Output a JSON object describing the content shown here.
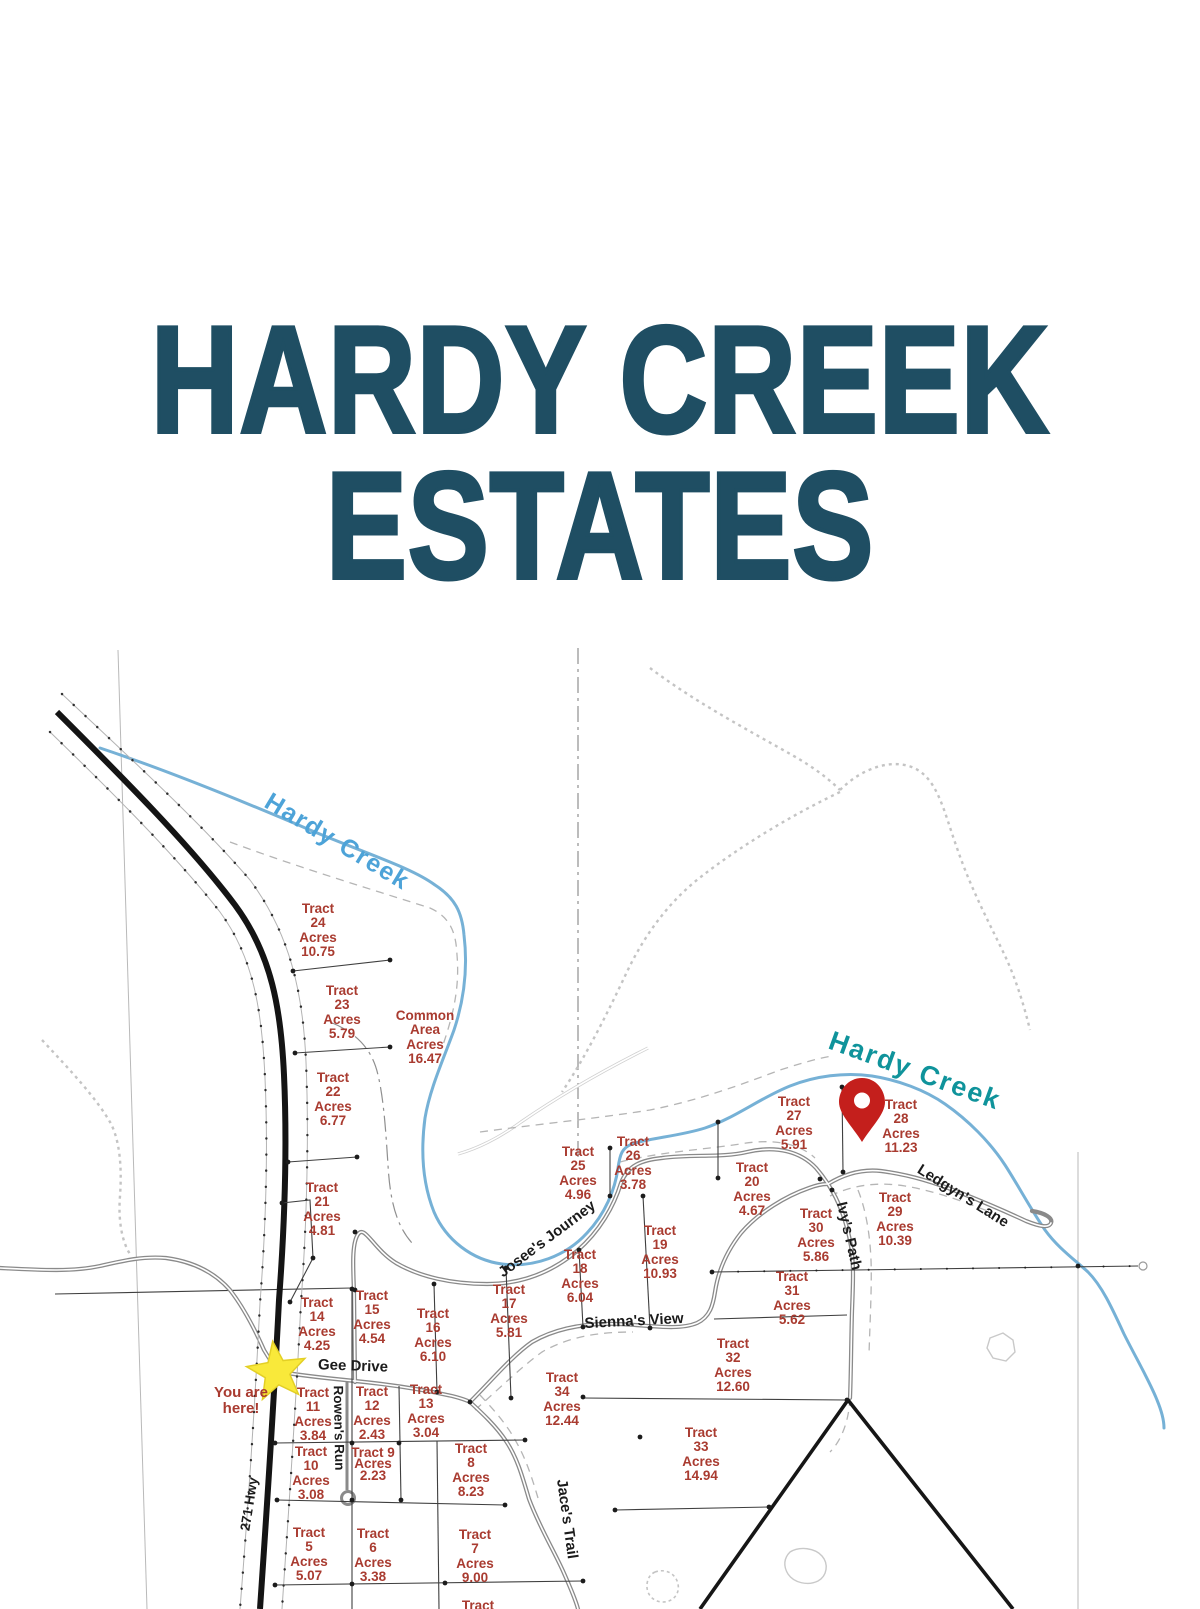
{
  "title": {
    "line1": "HARDY CREEK",
    "line2": "ESTATES"
  },
  "colors": {
    "title": "#1f4e63",
    "tract_text": "#a93b30",
    "creek": "#76b1d6",
    "creek_label_left": "#4da3d8",
    "creek_label_right": "#0f939b",
    "road": "#8a8a8a",
    "highway": "#141414",
    "star": "#f9e93a",
    "pin": "#c41f1c"
  },
  "map": {
    "tracts": [
      {
        "id": "tract-24",
        "lines": [
          "Tract",
          "24",
          "Acres",
          "10.75"
        ],
        "x": 318,
        "y": 931
      },
      {
        "id": "tract-23",
        "lines": [
          "Tract",
          "23",
          "Acres",
          "5.79"
        ],
        "x": 342,
        "y": 1013
      },
      {
        "id": "common-area",
        "lines": [
          "Common",
          "Area",
          "Acres",
          "16.47"
        ],
        "x": 425,
        "y": 1038
      },
      {
        "id": "tract-22",
        "lines": [
          "Tract",
          "22",
          "Acres",
          "6.77"
        ],
        "x": 333,
        "y": 1100
      },
      {
        "id": "tract-21",
        "lines": [
          "Tract",
          "21",
          "Acres",
          "4.81"
        ],
        "x": 322,
        "y": 1210
      },
      {
        "id": "tract-25",
        "lines": [
          "Tract",
          "25",
          "Acres",
          "4.96"
        ],
        "x": 578,
        "y": 1174
      },
      {
        "id": "tract-26",
        "lines": [
          "Tract",
          "26",
          "Acres",
          "3.78"
        ],
        "x": 633,
        "y": 1164
      },
      {
        "id": "tract-27",
        "lines": [
          "Tract",
          "27",
          "Acres",
          "5.91"
        ],
        "x": 794,
        "y": 1124
      },
      {
        "id": "tract-28",
        "lines": [
          "Tract",
          "28",
          "Acres",
          "11.23"
        ],
        "x": 901,
        "y": 1127
      },
      {
        "id": "tract-20",
        "lines": [
          "Tract",
          "20",
          "Acres",
          "4.67"
        ],
        "x": 752,
        "y": 1190
      },
      {
        "id": "tract-29",
        "lines": [
          "Tract",
          "29",
          "Acres",
          "10.39"
        ],
        "x": 895,
        "y": 1220
      },
      {
        "id": "tract-30",
        "lines": [
          "Tract",
          "30",
          "Acres",
          "5.86"
        ],
        "x": 816,
        "y": 1236
      },
      {
        "id": "tract-19",
        "lines": [
          "Tract",
          "19",
          "Acres",
          "10.93"
        ],
        "x": 660,
        "y": 1253
      },
      {
        "id": "tract-18",
        "lines": [
          "Tract",
          "18",
          "Acres",
          "6.04"
        ],
        "x": 580,
        "y": 1277
      },
      {
        "id": "tract-31",
        "lines": [
          "Tract",
          "31",
          "Acres",
          "5.62"
        ],
        "x": 792,
        "y": 1299
      },
      {
        "id": "tract-17",
        "lines": [
          "Tract",
          "17",
          "Acres",
          "5.81"
        ],
        "x": 509,
        "y": 1312
      },
      {
        "id": "tract-14",
        "lines": [
          "Tract",
          "14",
          "Acres",
          "4.25"
        ],
        "x": 317,
        "y": 1325
      },
      {
        "id": "tract-15",
        "lines": [
          "Tract",
          "15",
          "Acres",
          "4.54"
        ],
        "x": 372,
        "y": 1318
      },
      {
        "id": "tract-16",
        "lines": [
          "Tract",
          "16",
          "Acres",
          "6.10"
        ],
        "x": 433,
        "y": 1336
      },
      {
        "id": "tract-32",
        "lines": [
          "Tract",
          "32",
          "Acres",
          "12.60"
        ],
        "x": 733,
        "y": 1366
      },
      {
        "id": "tract-34",
        "lines": [
          "Tract",
          "34",
          "Acres",
          "12.44"
        ],
        "x": 562,
        "y": 1400
      },
      {
        "id": "tract-11",
        "lines": [
          "Tract",
          "11",
          "Acres",
          "3.84"
        ],
        "x": 313,
        "y": 1415
      },
      {
        "id": "tract-12",
        "lines": [
          "Tract",
          "12",
          "Acres",
          "2.43"
        ],
        "x": 372,
        "y": 1414
      },
      {
        "id": "tract-13",
        "lines": [
          "Tract",
          "13",
          "Acres",
          "3.04"
        ],
        "x": 426,
        "y": 1412
      },
      {
        "id": "tract-33",
        "lines": [
          "Tract",
          "33",
          "Acres",
          "14.94"
        ],
        "x": 701,
        "y": 1455
      },
      {
        "id": "tract-9",
        "lines": [
          "Tract 9",
          "Acres",
          "2.23"
        ],
        "x": 373,
        "y": 1464,
        "cls": "tight"
      },
      {
        "id": "tract-10",
        "lines": [
          "Tract",
          "10",
          "Acres",
          "3.08"
        ],
        "x": 311,
        "y": 1474
      },
      {
        "id": "tract-8",
        "lines": [
          "Tract",
          "8",
          "Acres",
          "8.23"
        ],
        "x": 471,
        "y": 1471
      },
      {
        "id": "tract-5",
        "lines": [
          "Tract",
          "5",
          "Acres",
          "5.07"
        ],
        "x": 309,
        "y": 1555
      },
      {
        "id": "tract-6",
        "lines": [
          "Tract",
          "6",
          "Acres",
          "3.38"
        ],
        "x": 373,
        "y": 1556
      },
      {
        "id": "tract-7",
        "lines": [
          "Tract",
          "7",
          "Acres",
          "9.00"
        ],
        "x": 475,
        "y": 1557
      },
      {
        "id": "tract-partial-bottom",
        "lines": [
          "Tract"
        ],
        "x": 478,
        "y": 1606
      },
      {
        "id": "you-are-here-note",
        "lines": [
          "You are",
          "here!"
        ],
        "x": 241,
        "y": 1401,
        "cls": "note-label"
      }
    ],
    "road_labels": [
      {
        "id": "hardy-creek-label-upper",
        "text": "Hardy Creek",
        "x": 337,
        "y": 842,
        "rot": 31,
        "cls": "creek-lbl-left"
      },
      {
        "id": "hardy-creek-label-lower",
        "text": "Hardy Creek",
        "x": 915,
        "y": 1071,
        "rot": 20,
        "cls": "creek-lbl-right"
      },
      {
        "id": "josees-journey-label",
        "text": "Josee's Journey",
        "x": 547,
        "y": 1239,
        "rot": -37
      },
      {
        "id": "siennas-view-label",
        "text": "Sienna's View",
        "x": 634,
        "y": 1321,
        "rot": -3
      },
      {
        "id": "gee-drive-label",
        "text": "Gee Drive",
        "x": 353,
        "y": 1366,
        "rot": 2
      },
      {
        "id": "ledgyns-lane-label",
        "text": "Ledgyn's Lane",
        "x": 963,
        "y": 1196,
        "rot": 32
      },
      {
        "id": "ivys-path-label",
        "text": "Ivy's Path",
        "x": 849,
        "y": 1236,
        "rot": 77
      },
      {
        "id": "jaces-trail-label",
        "text": "Jace's Trail",
        "x": 567,
        "y": 1519,
        "rot": 82
      },
      {
        "id": "rowens-run-label",
        "text": "Rowen's Run",
        "x": 339,
        "y": 1428,
        "rot": 89,
        "cls": "sm"
      },
      {
        "id": "hwy-271-label",
        "text": "271 Hwy",
        "x": 249,
        "y": 1504,
        "rot": -81,
        "cls": "sm"
      }
    ],
    "markers": {
      "pin": {
        "x": 862,
        "y": 1112
      },
      "star": {
        "x": 277,
        "y": 1372
      }
    }
  }
}
